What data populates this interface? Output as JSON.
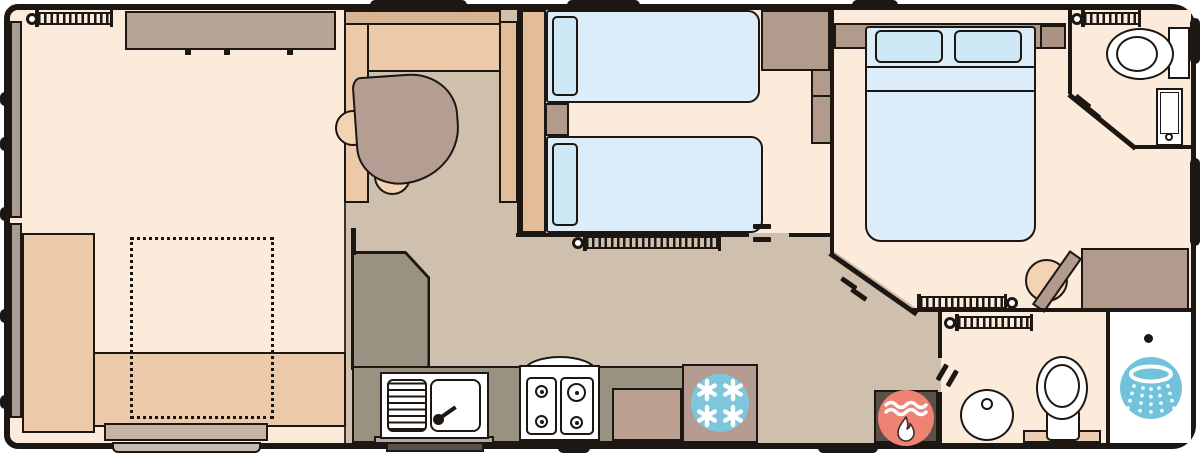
{
  "diagram": {
    "kind": "caravan-floor-plan",
    "canvas": {
      "width": 1200,
      "height": 453
    },
    "rooms": [
      "lounge",
      "dining-kitchen",
      "twin-bedroom",
      "double-bedroom",
      "wc",
      "bathroom",
      "shower-cubicle"
    ],
    "furniture": [
      "corner-sofa",
      "sofa-bed-outline",
      "footstool",
      "wall-sofa",
      "dining-table",
      "dining-chairs",
      "l-bench",
      "divider-unit",
      "kitchen-counter",
      "sink-drainer",
      "four-burner-hob",
      "oven-cupboard",
      "fridge-freezer",
      "twin-bed",
      "twin-bed",
      "bedside-table",
      "wardrobe",
      "shelf-unit",
      "double-bed",
      "headboard",
      "dressing-table",
      "vanity-chair",
      "toilet",
      "wash-basin",
      "toilet-mat",
      "shower-tray",
      "boiler",
      "radiator",
      "entrance-steps",
      "windows"
    ],
    "icons": [
      {
        "name": "freezer-icon",
        "meaning": "fridge freezer",
        "glyph": "four 6-arm snowflakes in blue circle"
      },
      {
        "name": "boiler-icon",
        "meaning": "gas boiler / water heater",
        "glyph": "white flame with wavy steam in red circle"
      },
      {
        "name": "shower-icon",
        "meaning": "shower head spray",
        "glyph": "white spray ring with dotted jets in blue circle"
      },
      {
        "name": "radiator-icon",
        "meaning": "wall radiator",
        "glyph": "hatched bar with valve knob"
      }
    ]
  },
  "palette": {
    "wall_black": "#1c1712",
    "floor_light": "#fcebda",
    "floor_kitchen": "#cfc0ae",
    "floor_shower": "#ffffff",
    "sofa_tan": "#eccaa9",
    "bench_back": "#d9b493",
    "unit_tan": "#e3bd98",
    "sofa_gray": "#b7a698",
    "footstool_gray": "#c3b4a5",
    "table_mauve": "#b49e94",
    "chair_peach": "#f2d3b3",
    "bed_blue": "#daedf8",
    "pillow_blue": "#cfe8f5",
    "wood_brown": "#b29a8c",
    "wood_dark": "#ab9384",
    "counter_olive": "#9a9280",
    "oven_brown": "#bb9f91",
    "fridge_panel": "#b59c92",
    "freezer_blue": "#7ec6db",
    "boiler_red": "#ee8273",
    "shower_blue": "#70c3da",
    "boiler_box": "#5a5047",
    "step_gray": "#c6bab0",
    "step_dark": "#55504a",
    "window_gray": "#a99c92",
    "mat_tan": "#e9ceb4"
  }
}
